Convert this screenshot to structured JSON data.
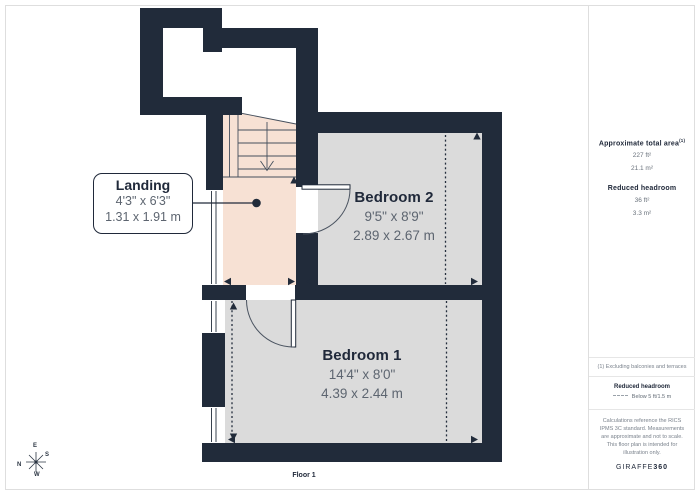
{
  "plan": {
    "floor_label": "Floor 1",
    "rooms": [
      {
        "name": "Landing",
        "dims_imperial": "4'3\" x 6'3\"",
        "dims_metric": "1.31 x 1.91 m"
      },
      {
        "name": "Bedroom 2",
        "dims_imperial": "9'5\" x 8'9\"",
        "dims_metric": "2.89 x 2.67 m"
      },
      {
        "name": "Bedroom 1",
        "dims_imperial": "14'4\" x 8'0\"",
        "dims_metric": "4.39 x 2.44 m"
      }
    ],
    "compass": {
      "n": "N",
      "e": "E",
      "s": "S",
      "w": "W"
    }
  },
  "sidebar": {
    "total_area": {
      "label": "Approximate total area",
      "footnote_marker": "(1)",
      "imperial": "227 ft²",
      "metric": "21.1 m²"
    },
    "reduced_headroom": {
      "label": "Reduced headroom",
      "imperial": "36 ft²",
      "metric": "3.3 m²"
    },
    "footnote": "(1) Excluding balconies and terraces",
    "legend": {
      "title": "Reduced headroom",
      "item": "Below 5 ft/1.5 m"
    },
    "disclaimer": "Calculations reference the RICS IPMS 3C standard. Measurements are approximate and not to scale. This floor plan is intended for illustration only.",
    "brand": {
      "name": "GIRAFFE",
      "suffix": "360"
    }
  },
  "colors": {
    "wall": "#212B3A",
    "room": "#DBDBDB",
    "landing": "#F7E1D4",
    "border": "#DEDEDE",
    "ink": "#20293A",
    "dim": "#5D6570",
    "muted": "#7A828C"
  }
}
